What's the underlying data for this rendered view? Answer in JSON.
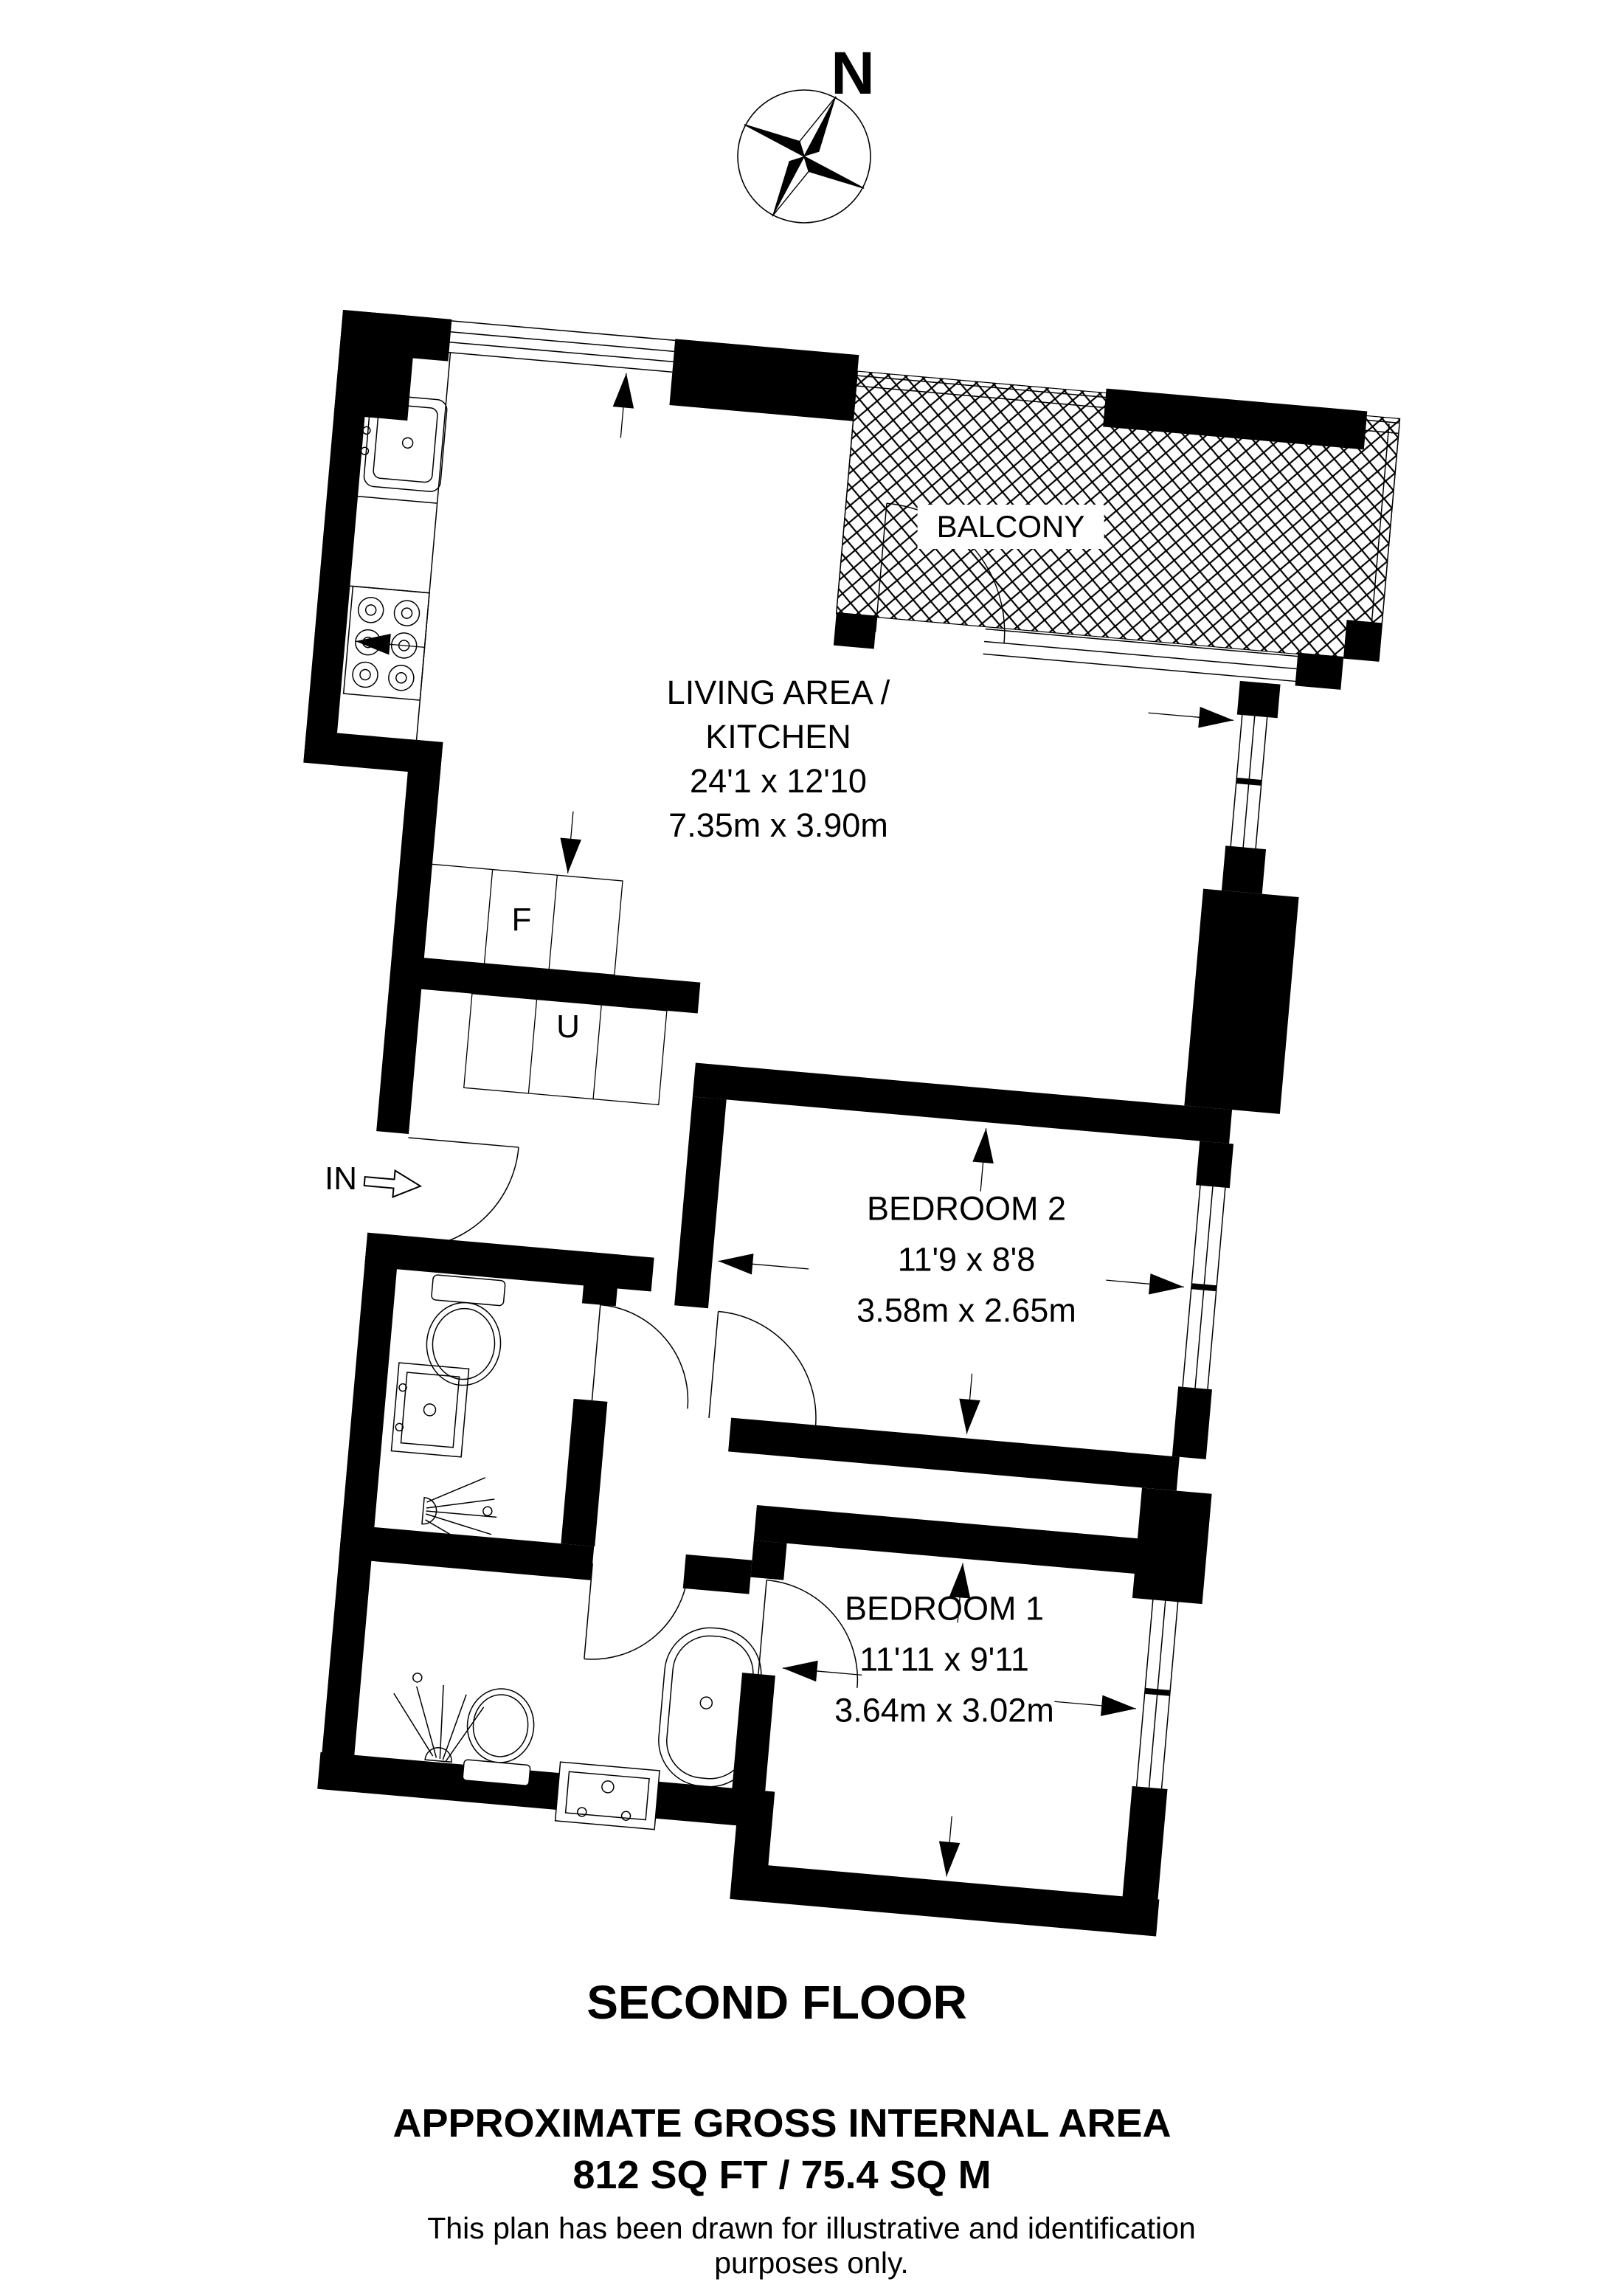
{
  "page": {
    "background": "#ffffff",
    "ink": "#000000"
  },
  "compass": {
    "label": "N"
  },
  "plan": {
    "balcony": {
      "label": "BALCONY"
    },
    "living": {
      "lines": "LIVING AREA /\nKITCHEN\n24'1 x 12'10\n7.35m x 3.90m"
    },
    "bedroom2": {
      "lines": "BEDROOM 2\n11'9 x 8'8\n3.58m x 2.65m"
    },
    "bedroom1": {
      "lines": "BEDROOM 1\n11'11 x 9'11\n3.64m x 3.02m"
    },
    "fridge_label": "F",
    "utility_label": "U",
    "entry_label": "IN"
  },
  "footer": {
    "floor_title": "SECOND FLOOR",
    "area_heading": "APPROXIMATE GROSS INTERNAL AREA",
    "area_value": "812 SQ FT / 75.4 SQ M",
    "disclaimer": "This plan has been drawn for illustrative and identification purposes only."
  }
}
